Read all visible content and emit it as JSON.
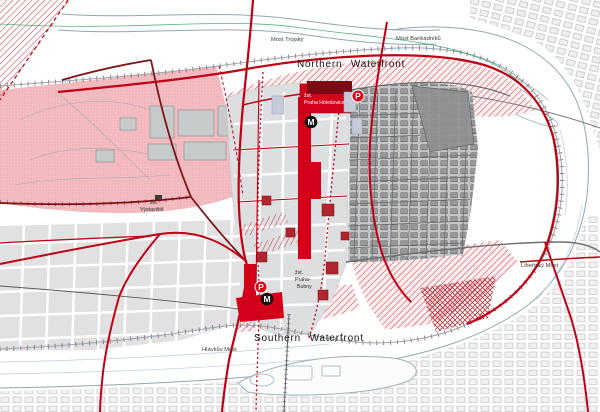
{
  "map": {
    "region_labels": {
      "northern_waterfront": "Northern Waterfront",
      "southern_waterfront": "Southern Waterfront"
    },
    "bridge_labels": {
      "most_trojsky": "Most Trojský",
      "most_barikadniku": "Most Barikádníků",
      "libensky_most": "Libeňský Most",
      "hlavkuv_most": "Hlávkův Most"
    },
    "station_labels": {
      "holesovice_line1": "žst.",
      "holesovice_line2": "Praha Holešovice",
      "bubny_line1": "žst.",
      "bubny_line2": "Praha-",
      "bubny_line3": "Bubny",
      "vystaviste_line1": "žst.",
      "vystaviste_line2": "Výstaviště"
    },
    "icons": {
      "metro_letter": "M",
      "parking_letter": "P"
    },
    "colors": {
      "accent_red": "#c10016",
      "bright_red_block": "#d40019",
      "dark_red": "#7a0b12",
      "pink_park": "#f4bdc1",
      "hatch_red": "#cf4049",
      "planned_gray": "#dcdee0",
      "existing_gray": "#c3c5c7",
      "dark_block_gray": "#8e9091",
      "river_line_blue": "#93a7b2",
      "green_path": "#2f9e68"
    }
  }
}
